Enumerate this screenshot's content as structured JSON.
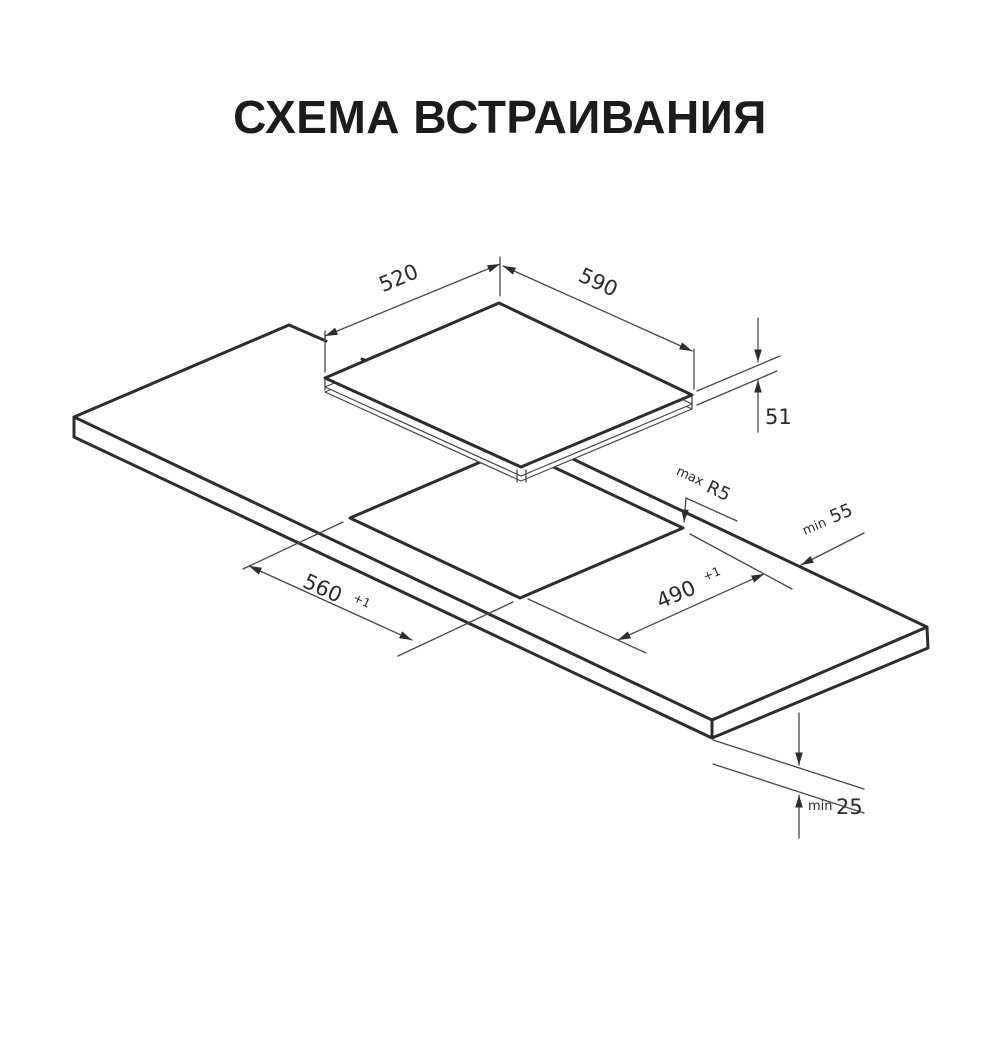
{
  "title": "СХЕМА ВСТРАИВАНИЯ",
  "dimensions": {
    "hob_width": "520",
    "hob_depth": "590",
    "hob_height": "51",
    "cutout_corner_radius_prefix": "max",
    "cutout_corner_radius": "R5",
    "edge_clearance_prefix": "min",
    "edge_clearance": "55",
    "cutout_width": "560",
    "cutout_width_tolerance": "+1",
    "cutout_depth": "490",
    "cutout_depth_tolerance": "+1",
    "bottom_clearance_prefix": "min",
    "bottom_clearance": "25"
  },
  "colors": {
    "line": "#2d2d2d",
    "text": "#2b2b2b",
    "background": "#ffffff"
  }
}
